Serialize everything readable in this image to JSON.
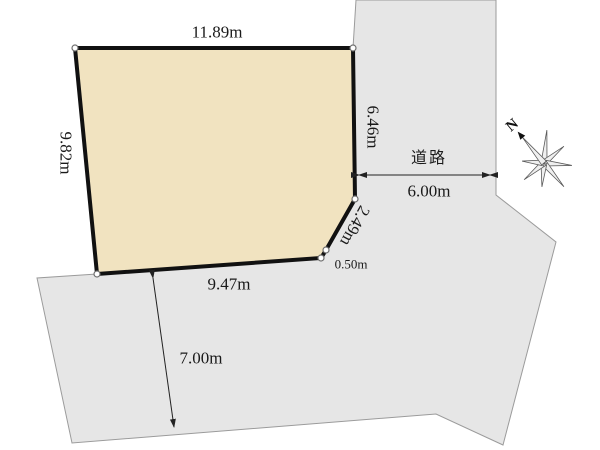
{
  "diagram": {
    "parcel": {
      "dimensions": {
        "top": "11.89m",
        "left": "9.82m",
        "right_upper": "6.46m",
        "corner_diagonal": "2.49m",
        "corner_cut": "0.50m",
        "bottom": "9.47m"
      }
    },
    "roads": {
      "east": {
        "name": "道路",
        "width": "6.00m"
      },
      "south": {
        "width": "7.00m"
      }
    },
    "compass": {
      "north_label": "N"
    },
    "colors": {
      "parcel-fill": "#f1e3c0",
      "parcel-outline": "#111111",
      "road-fill": "#e6e6e6",
      "road-outline": "#9b9b9b",
      "label-text": "#1a1a1a",
      "arrow": "#222222"
    }
  }
}
